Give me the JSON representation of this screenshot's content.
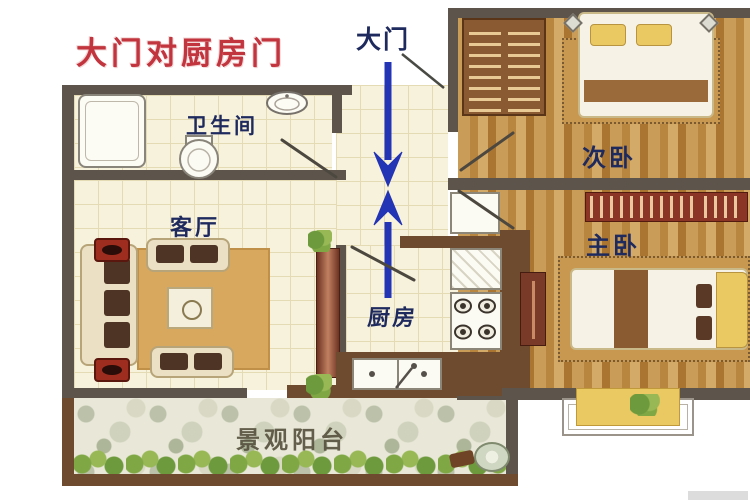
{
  "annotations": {
    "title": "大门对厨房门",
    "entry_door": "大门"
  },
  "rooms": {
    "bathroom": "卫生间",
    "living_room": "客厅",
    "kitchen": "厨房",
    "second_bedroom": "次卧",
    "master_bedroom": "主卧",
    "balcony": "景观阳台"
  },
  "colors": {
    "title_red": "#c2343e",
    "label_navy": "#1e2a5e",
    "arrow_blue": "#2334b5",
    "wall_gray": "#5d554c",
    "wall_brown": "#6e4a2e",
    "floor_cream": "#f7f2db",
    "grid_line": "#e4dab4",
    "rug_tan": "#d8a85e",
    "balcony_stone": "#e9e8d8",
    "plant_green": "#7fa845",
    "bay_yellow": "#eac963",
    "balcony_label": "#55503d"
  }
}
